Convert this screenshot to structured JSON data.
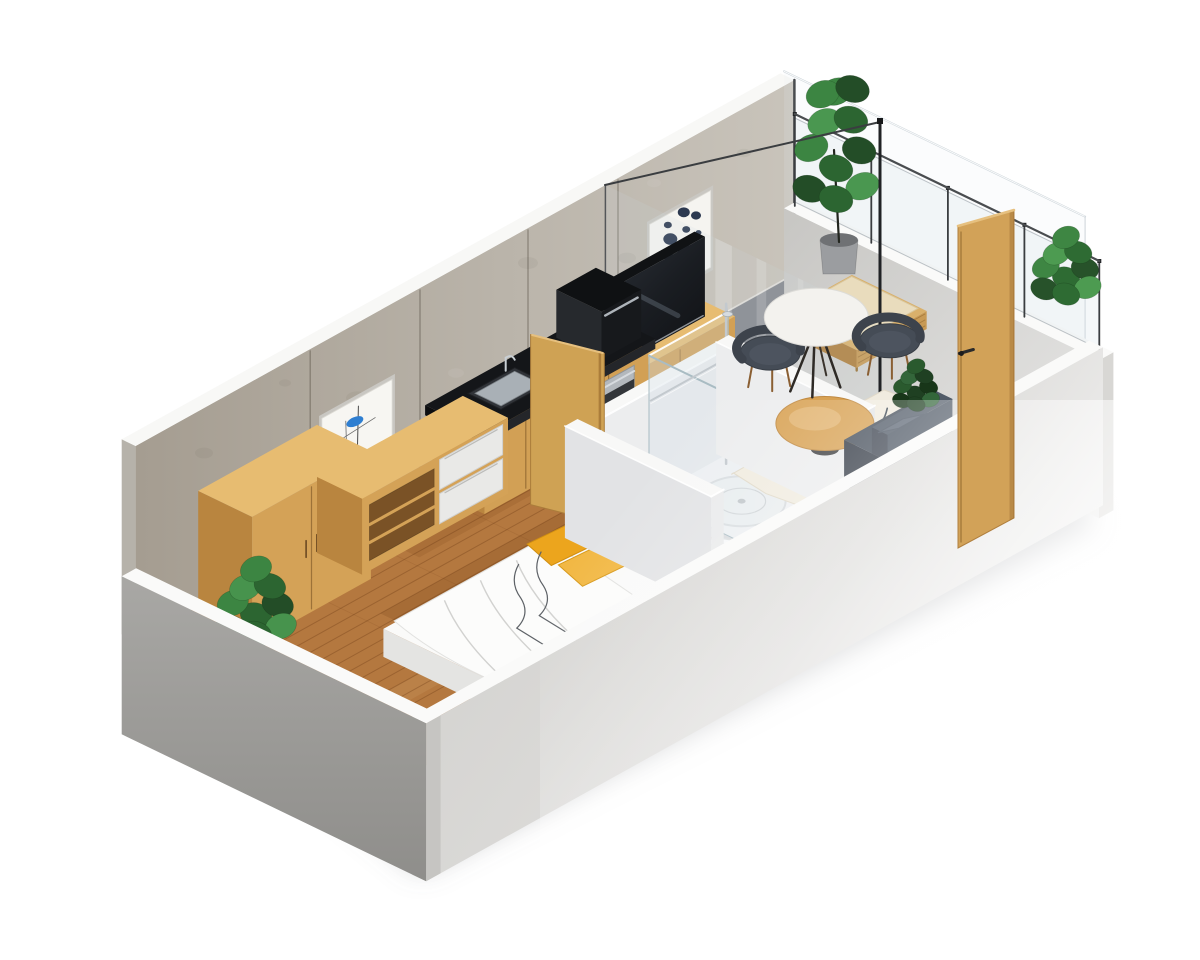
{
  "meta": {
    "title": "3D isometric cutaway floor plan of a studio apartment with balcony",
    "canvas": {
      "w": 1200,
      "h": 960
    },
    "background": "#ffffff"
  },
  "colors": {
    "wall_concrete_left": "#a8a094",
    "wall_concrete_right": "#c8c3ba",
    "wall_cut_top": "#f8f8f6",
    "wood_front": "#d2a055",
    "wood_top": "#e7bc71",
    "wood_side": "#b9853f",
    "door_wood": "#d2a258",
    "floor_wood": "#b4783f",
    "floor_balcony": "#85888d",
    "counter_black": "#141619",
    "bath_white": "#ecedee",
    "glass_edge": "#a9bcc3",
    "chair_grey": "#454c56",
    "sofa_grey": "#3d4551",
    "pillow_yellow": "#eca51d",
    "rug_cream": "#f0ebdf",
    "plant_green": "#3c8542",
    "chrome": "#c3c9ce",
    "slab_grey_sw": "#a9a8a5",
    "slab_grey_se": "#d2d1ce"
  },
  "scene": {
    "origin": [
      150,
      633
    ],
    "axes": {
      "ux": 0.9,
      "uy": 0.5,
      "vx": 0.87,
      "vy": 0.42
    },
    "items": [
      {
        "name": "ground-shadow",
        "kind": "shadowPoly",
        "pts": [
          [
            150,
            648
          ],
          [
            420,
            872
          ],
          [
            1095,
            525
          ],
          [
            1068,
            468
          ],
          [
            620,
            636
          ],
          [
            330,
            606
          ]
        ],
        "fill": "rgba(120,122,128,0.40)"
      },
      {
        "name": "back-wall",
        "kind": "backWall",
        "x0": -16,
        "x1": 716,
        "h": 195,
        "seams": [
          178,
          300,
          420,
          520
        ]
      },
      {
        "name": "wall-art-abstract",
        "kind": "artAbstract",
        "x0": 190,
        "x1": 268,
        "z0": 40,
        "z1": 120
      },
      {
        "name": "wall-art-dots",
        "kind": "artDots",
        "x0": 554,
        "x1": 622,
        "z0": 55,
        "z1": 132
      },
      {
        "name": "wood-floor",
        "kind": "floorWood",
        "x0": 0,
        "x1": 506,
        "y0": 0,
        "y1": 316,
        "step": 15
      },
      {
        "name": "balcony-floor",
        "kind": "floorBalcony",
        "x0": 506,
        "x1": 720,
        "y0": 0,
        "y1": 316
      },
      {
        "name": "balcony-end-glass",
        "kind": "glassPlaneV",
        "x": 720,
        "y0": -16,
        "y1": 330,
        "z0": 0,
        "z1": 195,
        "bright": true
      },
      {
        "name": "balcony-end-wall",
        "kind": "boxStd",
        "x": 720,
        "y": -16,
        "z": -100,
        "dx": 16,
        "dy": 362,
        "dz": 158,
        "top": "#fafaf9",
        "front": "#d8d7d4",
        "end": "url(#gRight)"
      },
      {
        "name": "balcony-railing",
        "kind": "railing",
        "x": 728,
        "y0": -12,
        "y1": 338,
        "zb": 58,
        "zt": 150,
        "posts": [
          -12,
          76,
          164,
          252,
          338
        ]
      },
      {
        "name": "balcony-shrub",
        "kind": "plant",
        "px": 1066,
        "py": 282,
        "r": 27,
        "tall": false,
        "palette": [
          "#2e6b33",
          "#3e8643",
          "#27522a",
          "#4d9b51"
        ]
      },
      {
        "name": "balcony-plant",
        "kind": "plant",
        "px": 836,
        "py": 176,
        "r": 33,
        "tall": true,
        "pot": {
          "x": 820,
          "y": 240,
          "w": 38,
          "h": 34,
          "fill": "#9b9da0"
        },
        "trunk": [
          [
            839,
            242
          ],
          [
            834,
            150
          ]
        ],
        "palette": [
          "#2c6531",
          "#3c8542",
          "#234d27",
          "#4a9750"
        ]
      },
      {
        "name": "lounger",
        "kind": "lounger",
        "x": 640,
        "y": 64,
        "dx": 78,
        "dy": 86,
        "zb": 8,
        "zt": 26
      },
      {
        "name": "living-balcony-glass",
        "kind": "divider",
        "x": 506,
        "y0": 0,
        "y1": 316,
        "z": 195
      },
      {
        "name": "tv-console",
        "kind": "boxStd",
        "x": 470,
        "y": 14,
        "z": 0,
        "dx": 122,
        "dy": 46,
        "dz": 46,
        "top": "#e7bc71",
        "front": "#d2a055",
        "end": "#b9853f",
        "frontLines": true
      },
      {
        "name": "tv",
        "kind": "tv",
        "x": 476,
        "y": 30,
        "dx": 100,
        "dy": 12,
        "z0": 46,
        "z1": 126
      },
      {
        "name": "kitchen-cabinets",
        "kind": "boxStd",
        "x": 300,
        "y": 14,
        "z": 0,
        "dx": 182,
        "dy": 60,
        "dz": 74,
        "top": "#d2a055",
        "front": "#d2a055",
        "end": "#b9853f",
        "seamsX": [
          346,
          392,
          438
        ]
      },
      {
        "name": "kitchen-counter",
        "kind": "counter",
        "x": 296,
        "y": 10,
        "dx": 190,
        "dy": 68,
        "z": 74,
        "th": 10,
        "sink": [
          330,
          24,
          52,
          38
        ]
      },
      {
        "name": "kitchen-appliance",
        "kind": "boxStd",
        "x": 436,
        "y": 16,
        "z": 84,
        "dx": 44,
        "dy": 52,
        "dz": 48,
        "top": "#0f1113",
        "front": "#17191c",
        "end": "#26292d",
        "handle": true
      },
      {
        "name": "kitchen-oven",
        "kind": "ovenFront",
        "x0": 420,
        "x1": 466,
        "y": 74.5,
        "z0": 18,
        "z1": 66
      },
      {
        "name": "bathroom-back-wall",
        "kind": "boxStd",
        "x": 330,
        "y": 150,
        "z": 0,
        "dx": 154,
        "dy": 14,
        "dz": 112,
        "top": "#f8f8f7",
        "front": "#ecedee",
        "end": "#dfe0e2",
        "glow": true
      },
      {
        "name": "bathroom-door",
        "kind": "door3",
        "bx1": 334,
        "by1": 92,
        "bx2": 352,
        "by2": 158,
        "z0": 0,
        "z1": 170,
        "fill": "#cfa254",
        "edge": "#ab7d3b"
      },
      {
        "name": "wardrobe",
        "kind": "boxStd",
        "x": 40,
        "y": 14,
        "z": 0,
        "dx": 132,
        "dy": 62,
        "dz": 128,
        "top": "#e7bc71",
        "front": "#d4a257",
        "end": "#b9853f",
        "seamsX": [
          106
        ],
        "handles": [
          100,
          112
        ]
      },
      {
        "name": "bedroom-plant",
        "kind": "plant",
        "px": 256,
        "py": 620,
        "r": 31,
        "tall": false,
        "pot": {
          "x": 244,
          "y": 652,
          "w": 26,
          "h": 20,
          "fill": "#8e9092"
        },
        "palette": [
          "#2c6531",
          "#3c8542",
          "#234d27",
          "#47934d"
        ]
      },
      {
        "name": "media-unit",
        "kind": "mediaUnit",
        "x": 172,
        "y": 14,
        "z": 0,
        "dx": 162,
        "dy": 52,
        "dz": 76
      },
      {
        "name": "bed",
        "kind": "bed",
        "x": 95,
        "y": 170,
        "dx": 207,
        "dy": 144,
        "h": 28
      },
      {
        "name": "shower-tray",
        "kind": "showerTray",
        "x": 392,
        "y": 168,
        "dx": 88,
        "dy": 122,
        "h": 10
      },
      {
        "name": "shower-glass-back",
        "kind": "glassPlaneU",
        "y": 168,
        "x0": 392,
        "x1": 480,
        "z0": 10,
        "z1": 152
      },
      {
        "name": "shower-glass-side",
        "kind": "glassPlaneV",
        "x": 392,
        "y0": 168,
        "y1": 290,
        "z0": 10,
        "z1": 152,
        "bright": false
      },
      {
        "name": "shower-fixture",
        "kind": "chrome"
      },
      {
        "name": "toilet",
        "kind": "toilet",
        "x": 361,
        "y": 281
      },
      {
        "name": "bathroom-left-wall",
        "kind": "boxStd",
        "x": 316,
        "y": 150,
        "z": 0,
        "dx": 14,
        "dy": 168,
        "dz": 112,
        "top": "#f8f8f7",
        "front": "#e9eaeb",
        "end": "#e2e3e5",
        "glow": true
      },
      {
        "name": "rug",
        "kind": "rug",
        "x0": 470,
        "y0": 182,
        "x1": 642,
        "y1": 308
      },
      {
        "name": "bathroom-right-wall",
        "kind": "boxStd",
        "x": 484,
        "y": 150,
        "z": 0,
        "dx": 14,
        "dy": 168,
        "dz": 112,
        "top": "#f8f8f7",
        "front": "#e4e5e7",
        "end": "#ecedee",
        "glow": true
      },
      {
        "name": "coffee-table",
        "kind": "coffeeTable",
        "x": 545,
        "y": 212,
        "r": 40,
        "h": 26
      },
      {
        "name": "dining-chair-left",
        "kind": "chair",
        "x": 575,
        "y": 118
      },
      {
        "name": "dining-table",
        "kind": "diningTable",
        "x": 605,
        "y": 140,
        "r": 42,
        "h": 72
      },
      {
        "name": "dining-chair-right",
        "kind": "chair",
        "x": 650,
        "y": 178
      },
      {
        "name": "sofa",
        "kind": "sofa",
        "x": 516,
        "y": 264,
        "dx": 72,
        "dy": 50
      },
      {
        "name": "sofa-plant",
        "kind": "plant",
        "px": 916,
        "py": 396,
        "r": 18,
        "tall": false,
        "palette": [
          "#1f4022",
          "#2a5a2e",
          "#183619",
          "#33663a"
        ]
      },
      {
        "name": "front-wall",
        "kind": "boxStd",
        "x": -16,
        "y": 318,
        "z": -100,
        "dx": 752,
        "dy": 16,
        "dz": 158,
        "top": "#fafaf9",
        "front": "url(#gSE)",
        "end": "#bdbcb9"
      },
      {
        "name": "left-end-wall",
        "kind": "boxStd",
        "x": -16,
        "y": -16,
        "z": -100,
        "dx": 16,
        "dy": 350,
        "dz": 158,
        "top": "#fafaf9",
        "front": "#c6c5c2",
        "end": "url(#gSW)"
      },
      {
        "name": "white-fade",
        "kind": "fade"
      },
      {
        "name": "entry-door",
        "kind": "doorScreen",
        "pts": [
          [
            958,
            226
          ],
          [
            1014,
            210
          ],
          [
            1014,
            518
          ],
          [
            958,
            548
          ]
        ],
        "fill": "#d2a258"
      }
    ]
  }
}
